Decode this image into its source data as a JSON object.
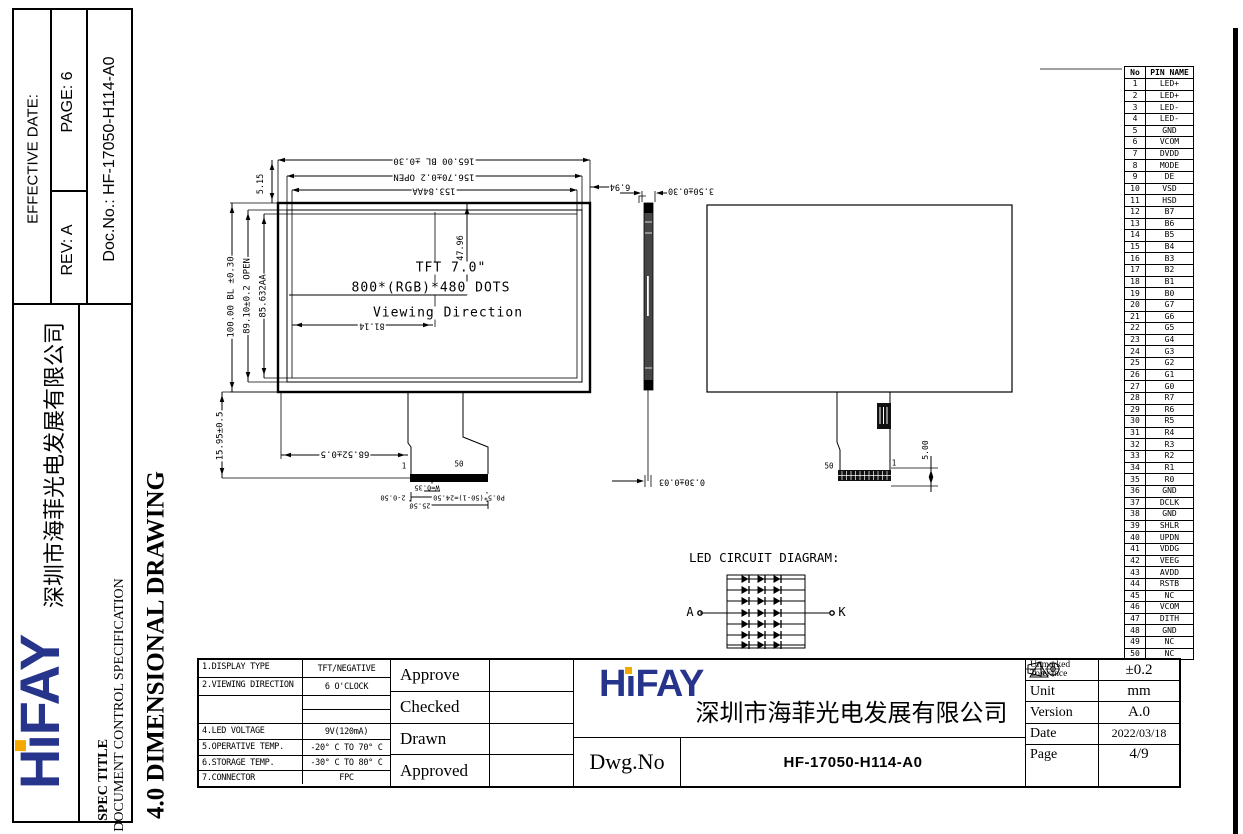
{
  "brand": "HIFAY",
  "colors": {
    "logo_blue": "#27348b",
    "logo_orange": "#f5a800",
    "ink": "#000000"
  },
  "sidebar": {
    "doc_no": "Doc.No.: HF-17050-H114-A0",
    "rev": "REV:  A",
    "page": "PAGE: 6",
    "effective_date": "EFFECTIVE DATE:",
    "company": "深圳市海菲光电发展有限公司",
    "spec_title_label": "SPEC TITLE",
    "spec_title_value": "DOCUMENT  CONTROL  SPECIFICATION",
    "section_heading": "4.0 DIMENSIONAL DRAWING"
  },
  "front_view": {
    "title_line1": "TFT 7.0\"",
    "title_line2": "800*(RGB)*480   DOTS",
    "title_line3": "Viewing  Direction",
    "dim_outline_w": "165.00 BL ±0.30",
    "dim_open_w": "156.70±0.2 OPEN",
    "dim_aa_w": "153.84AA",
    "dim_top": "5.15",
    "dim_right": "6.94",
    "dim_outline_h": "100.00 BL ±0.30",
    "dim_open_h": "89.10±0.2 OPEN",
    "dim_aa_h": "85.632AA",
    "dim_aa_center": "47.96",
    "dim_center_x": "81.14",
    "dim_tail_len": "15.95±0.5",
    "dim_tail_offset": "68.52±0.5",
    "pin_first": "1",
    "pin_last": "50",
    "dim_trace_w": "W=0.35",
    "dim_end_margin": "2-0.50",
    "dim_fpc_w": "25.50",
    "dim_pitch": "P0.5*(50-1)=24.50"
  },
  "side_view": {
    "dim_thickness": "3.50±0.30",
    "dim_fpc_t": "0.30±0.03"
  },
  "back_view": {
    "pin_last": "50",
    "pin_first": "1",
    "dim_conn": "5.00"
  },
  "led_diagram": {
    "title": "LED CIRCUIT DIAGRAM:",
    "anode_label": "A",
    "cathode_label": "K",
    "rows": 7,
    "diodes_per_row": 3
  },
  "pin_table": {
    "headers": [
      "No",
      "PIN NAME"
    ],
    "rows": [
      [
        "1",
        "LED+"
      ],
      [
        "2",
        "LED+"
      ],
      [
        "3",
        "LED-"
      ],
      [
        "4",
        "LED-"
      ],
      [
        "5",
        "GND"
      ],
      [
        "6",
        "VCOM"
      ],
      [
        "7",
        "DVDD"
      ],
      [
        "8",
        "MODE"
      ],
      [
        "9",
        "DE"
      ],
      [
        "10",
        "VSD"
      ],
      [
        "11",
        "HSD"
      ],
      [
        "12",
        "B7"
      ],
      [
        "13",
        "B6"
      ],
      [
        "14",
        "B5"
      ],
      [
        "15",
        "B4"
      ],
      [
        "16",
        "B3"
      ],
      [
        "17",
        "B2"
      ],
      [
        "18",
        "B1"
      ],
      [
        "19",
        "B0"
      ],
      [
        "20",
        "G7"
      ],
      [
        "21",
        "G6"
      ],
      [
        "22",
        "G5"
      ],
      [
        "23",
        "G4"
      ],
      [
        "24",
        "G3"
      ],
      [
        "25",
        "G2"
      ],
      [
        "26",
        "G1"
      ],
      [
        "27",
        "G0"
      ],
      [
        "28",
        "R7"
      ],
      [
        "29",
        "R6"
      ],
      [
        "30",
        "R5"
      ],
      [
        "31",
        "R4"
      ],
      [
        "32",
        "R3"
      ],
      [
        "33",
        "R2"
      ],
      [
        "34",
        "R1"
      ],
      [
        "35",
        "R0"
      ],
      [
        "36",
        "GND"
      ],
      [
        "37",
        "DCLK"
      ],
      [
        "38",
        "GND"
      ],
      [
        "39",
        "SHLR"
      ],
      [
        "40",
        "UPDN"
      ],
      [
        "41",
        "VDDG"
      ],
      [
        "42",
        "VEEG"
      ],
      [
        "43",
        "AVDD"
      ],
      [
        "44",
        "RSTB"
      ],
      [
        "45",
        "NC"
      ],
      [
        "46",
        "VCOM"
      ],
      [
        "47",
        "DITH"
      ],
      [
        "48",
        "GND"
      ],
      [
        "49",
        "NC"
      ],
      [
        "50",
        "NC"
      ]
    ]
  },
  "title_block": {
    "specs": [
      {
        "label": "1.DISPLAY TYPE",
        "value": "TFT/NEGATIVE"
      },
      {
        "label": "2.VIEWING DIRECTION",
        "value": "6 O'CLOCK"
      },
      {
        "label": "",
        "value": ""
      },
      {
        "label": "4.LED  VOLTAGE",
        "value": "9V(120mA)"
      },
      {
        "label": "5.OPERATIVE TEMP.",
        "value": "-20° C TO 70° C"
      },
      {
        "label": "6.STORAGE TEMP.",
        "value": "-30° C TO 80° C"
      },
      {
        "label": "7.CONNECTOR",
        "value": "FPC"
      }
    ],
    "sign_labels": [
      "Approve",
      "Checked",
      "Drawn",
      "Approved"
    ],
    "company": "深圳市海菲光电发展有限公司",
    "dwg_no_label": "Dwg.No",
    "dwg_no_value": "HF-17050-H114-A0",
    "info": [
      {
        "label": "Unmarked Tolerance",
        "value": "±0.2"
      },
      {
        "label": "Unit",
        "value": "mm"
      },
      {
        "label": "Version",
        "value": "A.0"
      },
      {
        "label": "Date",
        "value": "2022/03/18"
      },
      {
        "label": "Page",
        "value": "4/9"
      }
    ],
    "roughness": "1.0"
  }
}
